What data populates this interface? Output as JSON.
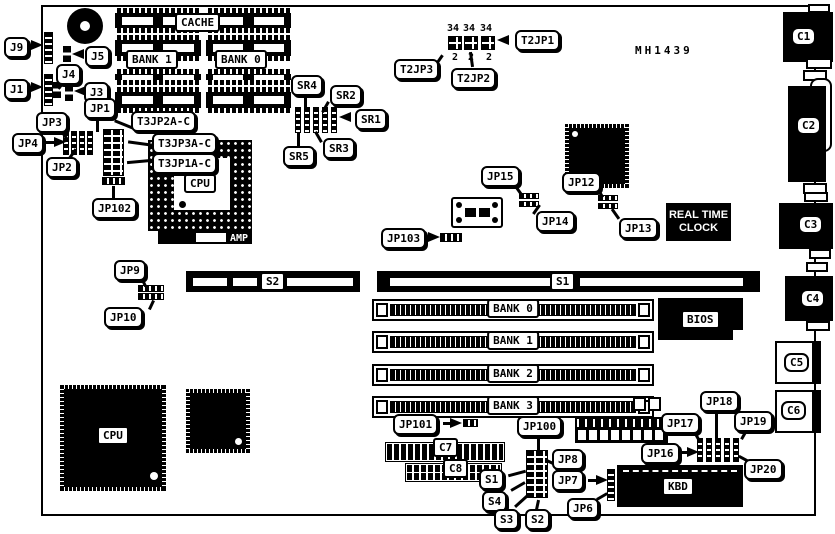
{
  "part_number": "MH1439",
  "connector_labels": {
    "c1": "C1",
    "c2": "C2",
    "c3": "C3",
    "c4": "C4",
    "c5": "C5",
    "c6": "C6"
  },
  "chip_labels": {
    "cache": "CACHE",
    "bank1_cache": "BANK 1",
    "bank0_cache": "BANK 0",
    "cpu_socket": "CPU",
    "amp": "AMP",
    "cpu": "CPU",
    "bios": "BIOS",
    "kbd": "KBD",
    "rtc_line1": "REAL TIME",
    "rtc_line2": "CLOCK"
  },
  "slot_labels": {
    "s1": "S1",
    "s2": "S2",
    "bank0": "BANK 0",
    "bank1": "BANK 1",
    "bank2": "BANK 2",
    "bank3": "BANK 3"
  },
  "header_labels": {
    "c7": "C7",
    "c8": "C8"
  },
  "t2jp_pins": {
    "top": [
      "34",
      "34",
      "34"
    ],
    "bottom": [
      "2",
      "2",
      "2"
    ]
  },
  "callouts": {
    "j1": "J1",
    "j3": "J3",
    "j4": "J4",
    "j5": "J5",
    "j9": "J9",
    "jp1": "JP1",
    "jp2": "JP2",
    "jp3": "JP3",
    "jp4": "JP4",
    "jp6": "JP6",
    "jp7": "JP7",
    "jp8": "JP8",
    "jp9": "JP9",
    "jp10": "JP10",
    "jp12": "JP12",
    "jp13": "JP13",
    "jp14": "JP14",
    "jp15": "JP15",
    "jp16": "JP16",
    "jp17": "JP17",
    "jp18": "JP18",
    "jp19": "JP19",
    "jp20": "JP20",
    "jp100": "JP100",
    "jp101": "JP101",
    "jp102": "JP102",
    "jp103": "JP103",
    "t3jp1": "T3JP1A-C",
    "t3jp2": "T3JP2A-C",
    "t3jp3": "T3JP3A-C",
    "t2jp1": "T2JP1",
    "t2jp2": "T2JP2",
    "t2jp3": "T2JP3",
    "sr1": "SR1",
    "sr2": "SR2",
    "sr3": "SR3",
    "sr4": "SR4",
    "sr5": "SR5",
    "s1": "S1",
    "s2": "S2",
    "s3": "S3",
    "s4": "S4"
  }
}
